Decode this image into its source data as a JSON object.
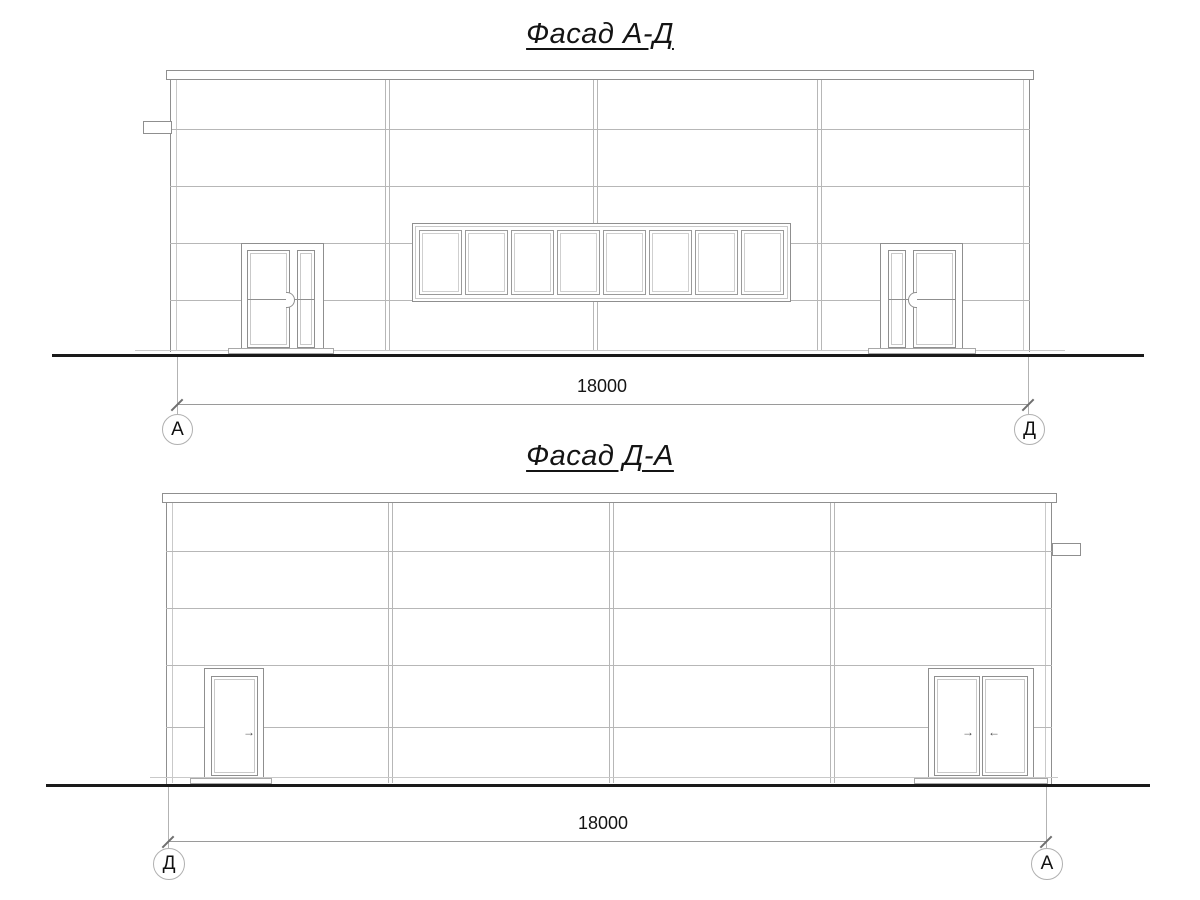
{
  "sheet": {
    "background": "#ffffff",
    "colors": {
      "ink": "#141414",
      "outline": "#8f8f8f",
      "panel_joint": "#b7b7b7",
      "ground": "#1a1a1a",
      "axis_circle": "#b0b0b0"
    }
  },
  "elevations": [
    {
      "id": "facade-ad",
      "title": "Фасад А-Д",
      "dimension_label": "18000",
      "axis_left": "А",
      "axis_right": "Д",
      "window_pane_count": 8
    },
    {
      "id": "facade-da",
      "title": "Фасад Д-А",
      "dimension_label": "18000",
      "axis_left": "Д",
      "axis_right": "А",
      "window_pane_count": 0
    }
  ],
  "glyphs": {
    "arrow_right": "→",
    "arrow_left": "←"
  }
}
